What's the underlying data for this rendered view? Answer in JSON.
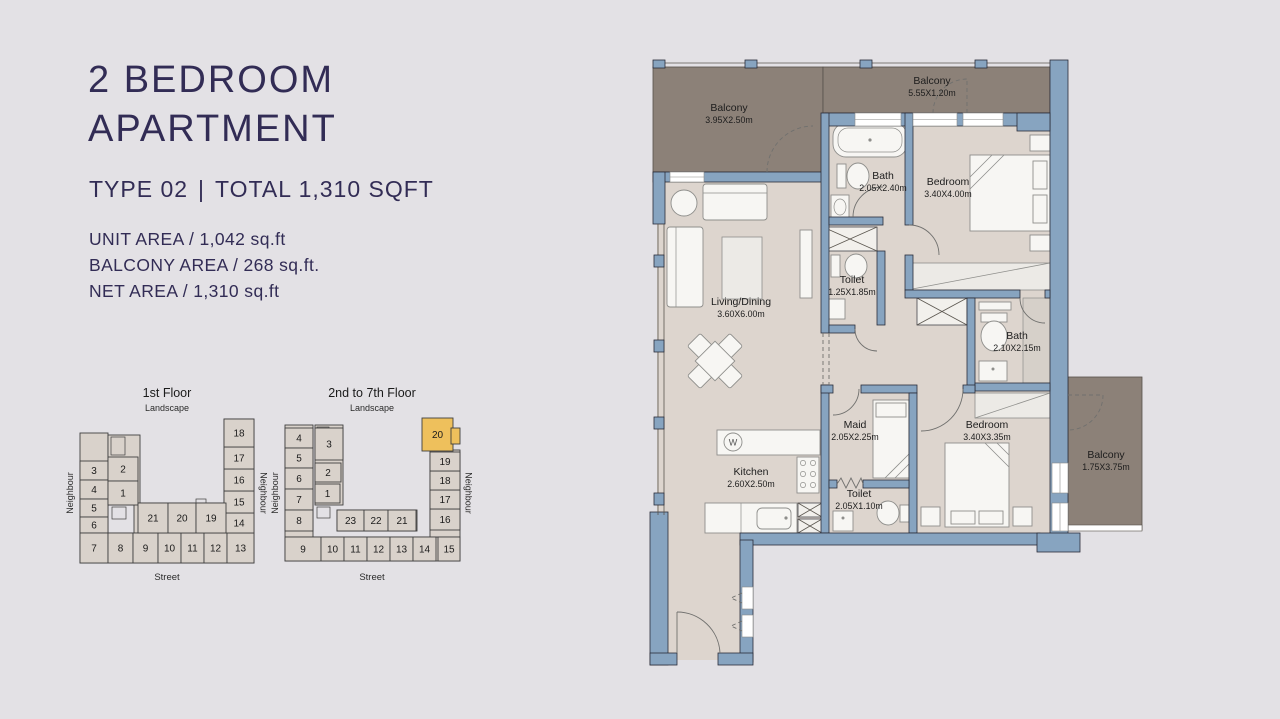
{
  "header": {
    "title_line1": "2 BEDROOM",
    "title_line2": "APARTMENT",
    "subtitle": {
      "type": "TYPE 02",
      "divider": "|",
      "total": "TOTAL 1,310 SQFT"
    },
    "areas": [
      "UNIT AREA / 1,042 sq.ft",
      "BALCONY AREA / 268 sq.ft.",
      "NET AREA / 1,310 sq.ft"
    ]
  },
  "colors": {
    "accent_navy": "#322c55",
    "wall_blue": "#87a4c0",
    "floor_beige": "#ddd5ce",
    "balcony_taupe": "#8c8178",
    "highlight_gold": "#eec05c",
    "background": "#e3e1e5"
  },
  "keyplans": [
    {
      "title": "1st Floor",
      "landscape": "Landscape",
      "street": "Street",
      "neighbour_left": "Neighbour",
      "neighbour_right": "Neighbour",
      "units": [
        {
          "n": "3",
          "x": 2,
          "y": 46,
          "w": 28,
          "h": 19
        },
        {
          "n": "4",
          "x": 2,
          "y": 65,
          "w": 28,
          "h": 19
        },
        {
          "n": "5",
          "x": 2,
          "y": 84,
          "w": 28,
          "h": 18
        },
        {
          "n": "6",
          "x": 2,
          "y": 102,
          "w": 28,
          "h": 16
        },
        {
          "n": "7",
          "x": 2,
          "y": 118,
          "w": 28,
          "h": 30
        },
        {
          "n": "8",
          "x": 30,
          "y": 118,
          "w": 25,
          "h": 30
        },
        {
          "n": "9",
          "x": 55,
          "y": 118,
          "w": 25,
          "h": 30
        },
        {
          "n": "10",
          "x": 80,
          "y": 118,
          "w": 23,
          "h": 30
        },
        {
          "n": "11",
          "x": 103,
          "y": 118,
          "w": 23,
          "h": 30
        },
        {
          "n": "12",
          "x": 126,
          "y": 118,
          "w": 23,
          "h": 30
        },
        {
          "n": "13",
          "x": 149,
          "y": 118,
          "w": 27,
          "h": 30
        },
        {
          "n": "14",
          "x": 146,
          "y": 98,
          "w": 30,
          "h": 20
        },
        {
          "n": "15",
          "x": 146,
          "y": 76,
          "w": 30,
          "h": 22
        },
        {
          "n": "16",
          "x": 146,
          "y": 54,
          "w": 30,
          "h": 22
        },
        {
          "n": "17",
          "x": 146,
          "y": 32,
          "w": 30,
          "h": 22
        },
        {
          "n": "18",
          "x": 146,
          "y": 4,
          "w": 30,
          "h": 28
        },
        {
          "n": "2",
          "x": 30,
          "y": 42,
          "w": 30,
          "h": 24
        },
        {
          "n": "1",
          "x": 30,
          "y": 66,
          "w": 30,
          "h": 24
        },
        {
          "n": "21",
          "x": 60,
          "y": 88,
          "w": 30,
          "h": 30
        },
        {
          "n": "20",
          "x": 90,
          "y": 88,
          "w": 28,
          "h": 30
        },
        {
          "n": "19",
          "x": 118,
          "y": 88,
          "w": 30,
          "h": 30
        }
      ]
    },
    {
      "title": "2nd to 7th Floor",
      "landscape": "Landscape",
      "street": "Street",
      "neighbour_left": "Neighbour",
      "neighbour_right": "Neighbour",
      "units": [
        {
          "n": "4",
          "x": 2,
          "y": 13,
          "w": 28,
          "h": 20
        },
        {
          "n": "5",
          "x": 2,
          "y": 33,
          "w": 28,
          "h": 20
        },
        {
          "n": "6",
          "x": 2,
          "y": 53,
          "w": 28,
          "h": 21
        },
        {
          "n": "7",
          "x": 2,
          "y": 74,
          "w": 28,
          "h": 21
        },
        {
          "n": "8",
          "x": 2,
          "y": 95,
          "w": 28,
          "h": 21
        },
        {
          "n": "9",
          "x": 2,
          "y": 122,
          "w": 36,
          "h": 24
        },
        {
          "n": "10",
          "x": 38,
          "y": 122,
          "w": 23,
          "h": 24
        },
        {
          "n": "11",
          "x": 61,
          "y": 122,
          "w": 23,
          "h": 24
        },
        {
          "n": "12",
          "x": 84,
          "y": 122,
          "w": 23,
          "h": 24
        },
        {
          "n": "13",
          "x": 107,
          "y": 122,
          "w": 23,
          "h": 24
        },
        {
          "n": "14",
          "x": 130,
          "y": 122,
          "w": 23,
          "h": 24
        },
        {
          "n": "15",
          "x": 155,
          "y": 122,
          "w": 22,
          "h": 24
        },
        {
          "n": "16",
          "x": 147,
          "y": 94,
          "w": 30,
          "h": 21
        },
        {
          "n": "17",
          "x": 147,
          "y": 75,
          "w": 30,
          "h": 19
        },
        {
          "n": "18",
          "x": 147,
          "y": 56,
          "w": 30,
          "h": 19
        },
        {
          "n": "19",
          "x": 147,
          "y": 37,
          "w": 30,
          "h": 19
        },
        {
          "n": "20",
          "x": 139,
          "y": 3,
          "w": 31,
          "h": 33,
          "hl": true,
          "tab": [
            168,
            13,
            9,
            16
          ]
        },
        {
          "n": "3",
          "x": 32,
          "y": 13,
          "w": 28,
          "h": 32
        },
        {
          "n": "2",
          "x": 32,
          "y": 48,
          "w": 26,
          "h": 19
        },
        {
          "n": "1",
          "x": 32,
          "y": 69,
          "w": 25,
          "h": 19
        },
        {
          "n": "23",
          "x": 54,
          "y": 95,
          "w": 27,
          "h": 21
        },
        {
          "n": "22",
          "x": 81,
          "y": 95,
          "w": 24,
          "h": 21
        },
        {
          "n": "21",
          "x": 105,
          "y": 95,
          "w": 28,
          "h": 21
        }
      ]
    }
  ],
  "floorplan": {
    "washer_label": "W",
    "rooms": [
      {
        "name": "Balcony",
        "dims": "3.95X2.50m",
        "x": 84,
        "y": 56
      },
      {
        "name": "Balcony",
        "dims": "5.55X1.20m",
        "x": 287,
        "y": 29
      },
      {
        "name": "Bath",
        "dims": "2.05X2.40m",
        "x": 238,
        "y": 124
      },
      {
        "name": "Bedroom",
        "dims": "3.40X4.00m",
        "x": 303,
        "y": 130
      },
      {
        "name": "Toilet",
        "dims": "1.25X1.85m",
        "x": 207,
        "y": 228
      },
      {
        "name": "Living/Dining",
        "dims": "3.60X6.00m",
        "x": 96,
        "y": 250
      },
      {
        "name": "Bath",
        "dims": "2.10X2.15m",
        "x": 372,
        "y": 284
      },
      {
        "name": "Maid",
        "dims": "2.05X2.25m",
        "x": 210,
        "y": 373
      },
      {
        "name": "Bedroom",
        "dims": "3.40X3.35m",
        "x": 342,
        "y": 373
      },
      {
        "name": "Kitchen",
        "dims": "2.60X2.50m",
        "x": 106,
        "y": 420
      },
      {
        "name": "Toilet",
        "dims": "2.05X1.10m",
        "x": 214,
        "y": 442
      },
      {
        "name": "Balcony",
        "dims": "1.75X3.75m",
        "x": 461,
        "y": 403
      }
    ]
  }
}
